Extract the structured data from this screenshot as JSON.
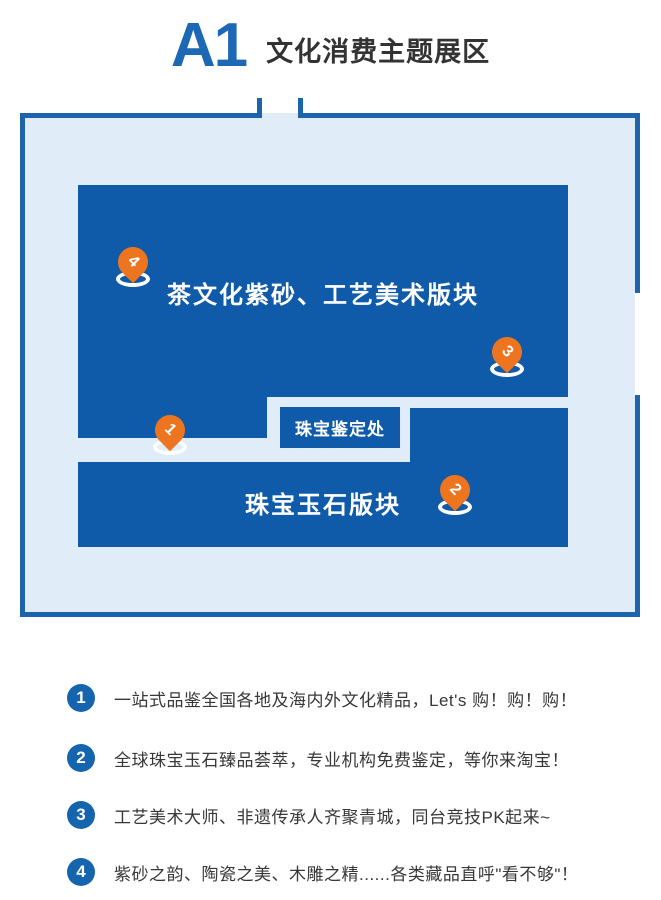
{
  "header": {
    "code": "A1",
    "title": "文化消费主题展区"
  },
  "map": {
    "upper_region_label": "茶文化紫砂、工艺美术版块",
    "lower_region_label": "珠宝玉石版块",
    "appraisal_office_label": "珠宝鉴定处",
    "pins": [
      {
        "number": "1"
      },
      {
        "number": "2"
      },
      {
        "number": "3"
      },
      {
        "number": "4"
      }
    ]
  },
  "legend": {
    "items": [
      {
        "number": "1",
        "text": "一站式品鉴全国各地及海内外文化精品，Let's 购！购！购！"
      },
      {
        "number": "2",
        "text": "全球珠宝玉石臻品荟萃，专业机构免费鉴定，等你来淘宝！"
      },
      {
        "number": "3",
        "text": "工艺美术大师、非遗传承人齐聚青城，同台竞技PK起来~"
      },
      {
        "number": "4",
        "text": "紫砂之韵、陶瓷之美、木雕之精......各类藏品直呼\"看不够\"！"
      }
    ]
  },
  "colors": {
    "accent_blue": "#1c68b5",
    "region_blue": "#0f5aa9",
    "map_border_blue": "#1d64ae",
    "map_fill_light_blue": "#e0edf8",
    "pin_orange": "#ee7520",
    "legend_badge_blue": "#1465ae",
    "text_dark": "#383838"
  }
}
